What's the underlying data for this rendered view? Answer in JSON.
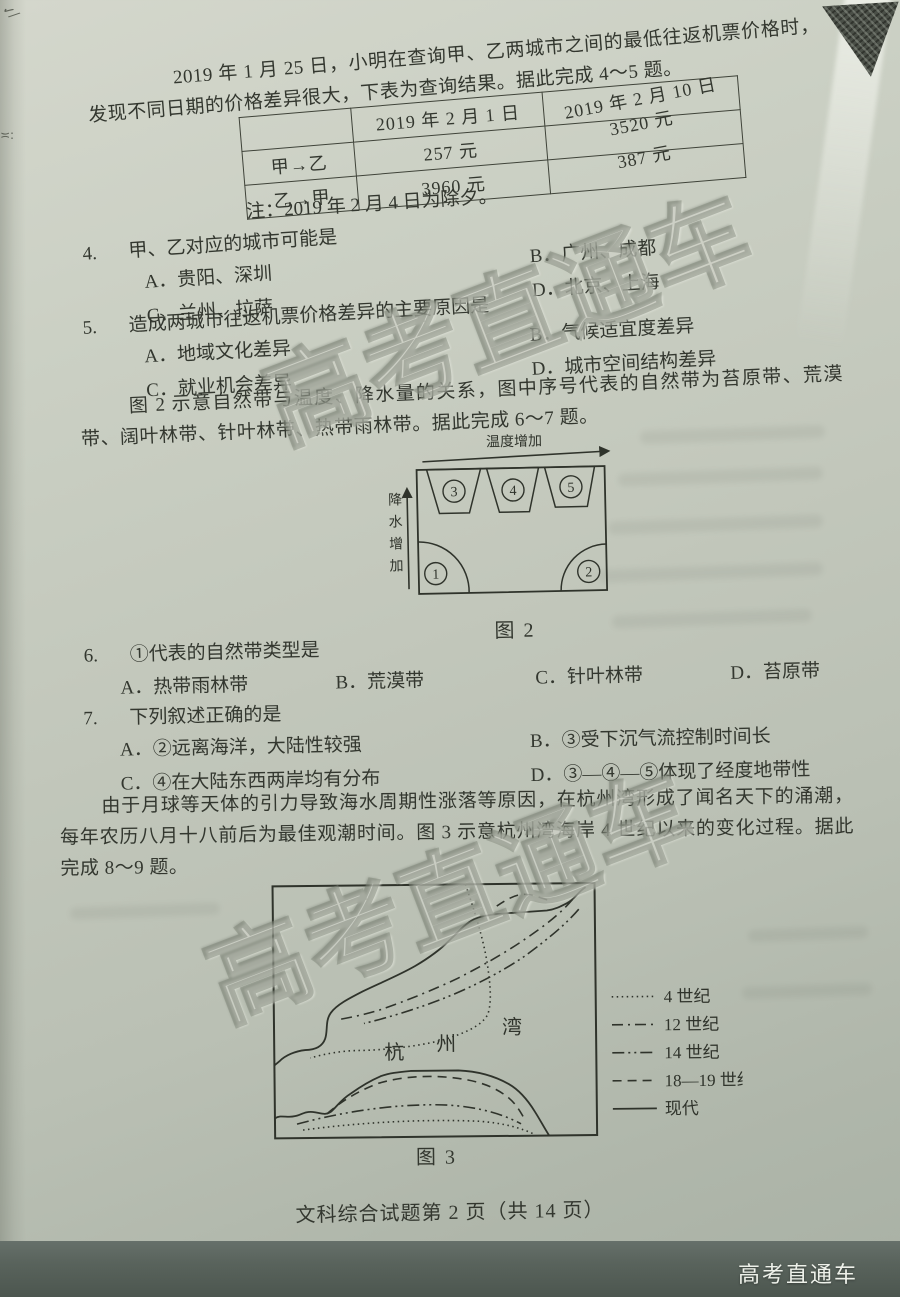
{
  "page": {
    "footer": "文科综合试题第 2 页（共 14 页）",
    "watermark": "高考直通车",
    "brand": "高考直通车"
  },
  "intro": {
    "text": "2019 年 1 月 25 日，小明在查询甲、乙两城市之间的最低往返机票价格时，发现不同日期的价格差异很大，下表为查询结果。据此完成 4～5 题。"
  },
  "price_table": {
    "col_headers": [
      "2019 年 2 月 1 日",
      "2019 年 2 月 10 日"
    ],
    "rows": [
      {
        "label": "甲→乙",
        "v1": "257 元",
        "v2": "3520 元"
      },
      {
        "label": "乙→甲",
        "v1": "3960 元",
        "v2": "387 元"
      }
    ],
    "note": "注：2019 年 2 月 4 日为除夕。"
  },
  "q4": {
    "num": "4.",
    "stem": "甲、乙对应的城市可能是",
    "options": [
      "A．贵阳、深圳",
      "B．广州、成都",
      "C．兰州、拉萨",
      "D．北京、上海"
    ]
  },
  "q5": {
    "num": "5.",
    "stem": "造成两城市往返机票价格差异的主要原因是",
    "options": [
      "A．地域文化差异",
      "B．气候适宜度差异",
      "C．就业机会差异",
      "D．城市空间结构差异"
    ]
  },
  "fig2_intro": {
    "text": "图 2 示意自然带与温度、降水量的关系，图中序号代表的自然带为苔原带、荒漠带、阔叶林带、针叶林带、热带雨林带。据此完成 6～7 题。"
  },
  "figure2": {
    "xlabel": "温度增加",
    "ylabel_chars": [
      "降",
      "水",
      "增",
      "加"
    ],
    "zones": [
      "1",
      "2",
      "3",
      "4",
      "5"
    ],
    "caption": "图 2"
  },
  "q6": {
    "num": "6.",
    "stem": "①代表的自然带类型是",
    "options": [
      "A．热带雨林带",
      "B．荒漠带",
      "C．针叶林带",
      "D．苔原带"
    ]
  },
  "q7": {
    "num": "7.",
    "stem": "下列叙述正确的是",
    "options": [
      "A．②远离海洋，大陆性较强",
      "B．③受下沉气流控制时间长",
      "C．④在大陆东西两岸均有分布",
      "D．③—④—⑤体现了经度地带性"
    ]
  },
  "hz_intro": {
    "text": "由于月球等天体的引力导致海水周期性涨落等原因，在杭州湾形成了闻名天下的涌潮，每年农历八月十八前后为最佳观潮时间。图 3 示意杭州湾海岸 4 世纪以来的变化过程。据此完成 8～9 题。"
  },
  "figure3": {
    "bay_chars": [
      "杭",
      "州",
      "湾"
    ],
    "legend": [
      {
        "label": "4 世纪",
        "style": "dotted"
      },
      {
        "label": "12 世纪",
        "style": "dash-dot"
      },
      {
        "label": "14 世纪",
        "style": "dash-dot-dot"
      },
      {
        "label": "18—19 世纪",
        "style": "dashed"
      },
      {
        "label": "现代",
        "style": "solid"
      }
    ],
    "caption": "图 3"
  }
}
